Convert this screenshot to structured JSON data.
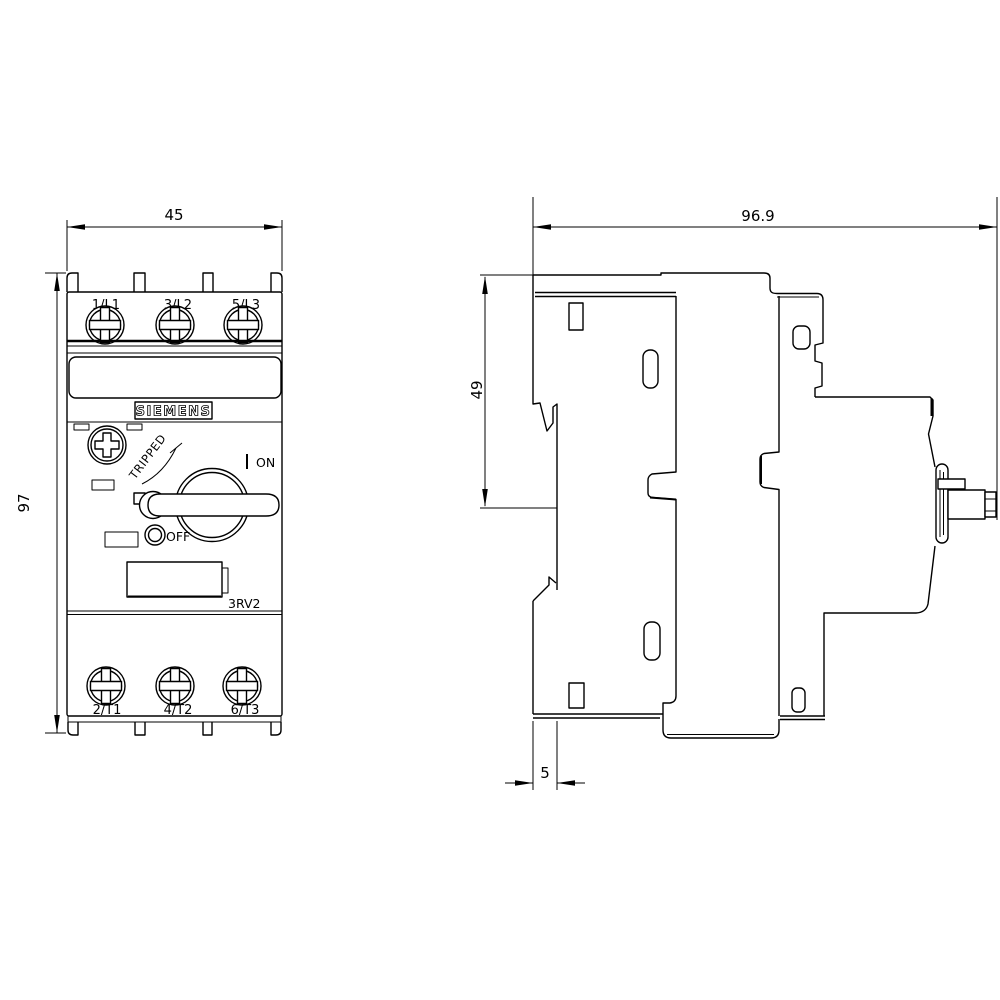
{
  "page": {
    "background": "#ffffff",
    "line_color": "#000000"
  },
  "front_view": {
    "width_dim": "45",
    "height_dim": "97",
    "brand": "SIEMENS",
    "model": "3RV2",
    "tripped_label": "TRIPPED",
    "on_label": "ON",
    "off_label": "OFF",
    "terminals_top": [
      "1/L1",
      "3/L2",
      "5/L3"
    ],
    "terminals_bottom": [
      "2/T1",
      "4/T2",
      "6/T3"
    ]
  },
  "side_view": {
    "depth_dim": "96.9",
    "upper_height_dim": "49",
    "rail_offset_dim": "5"
  }
}
